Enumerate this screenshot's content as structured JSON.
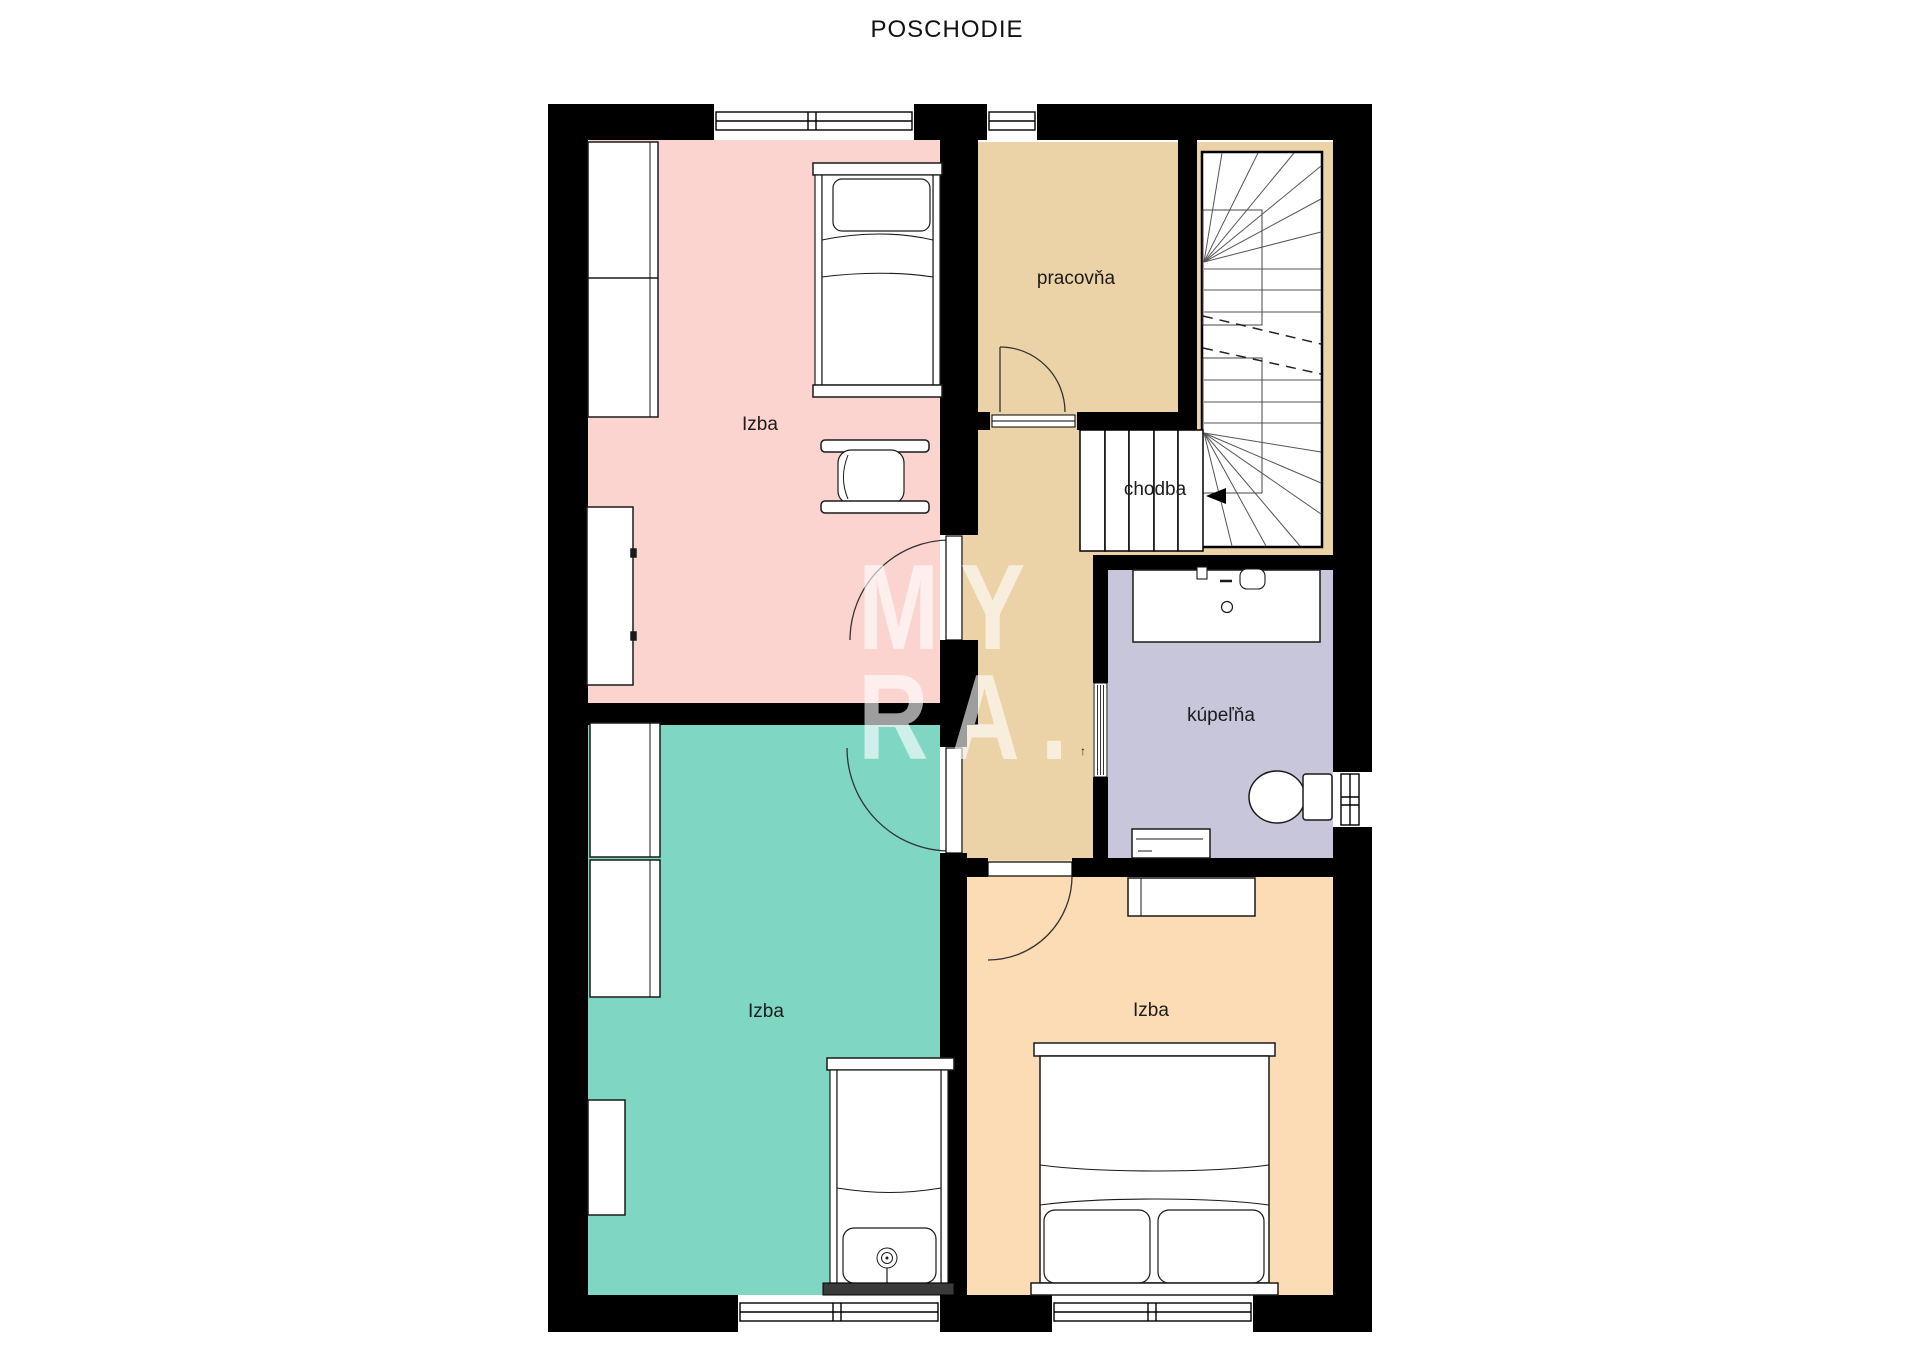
{
  "title": "POSCHODIE",
  "watermark": {
    "line1": "MY",
    "line2": "RA."
  },
  "rooms": {
    "bedroom_top_left": {
      "label": "Izba",
      "color": "#fbd3cf"
    },
    "office": {
      "label": "pracovňa",
      "color": "#ecd3a7"
    },
    "hallway": {
      "label": "chodba",
      "color": "#ecd3a7"
    },
    "bathroom": {
      "label": "kúpeľňa",
      "color": "#c7c6db"
    },
    "bedroom_bottom_left": {
      "label": "Izba",
      "color": "#7fd7c3"
    },
    "bedroom_bottom_right": {
      "label": "Izba",
      "color": "#fcdcb4"
    }
  },
  "icons": {
    "stair_direction_arrow": "left-triangle",
    "door_mark": "↑"
  },
  "colors": {
    "walls": "#000000",
    "background": "#ffffff",
    "stairs_fill": "#ffffff",
    "furniture_fill": "#ffffff",
    "watermark": "rgba(255,255,255,0.62)"
  }
}
